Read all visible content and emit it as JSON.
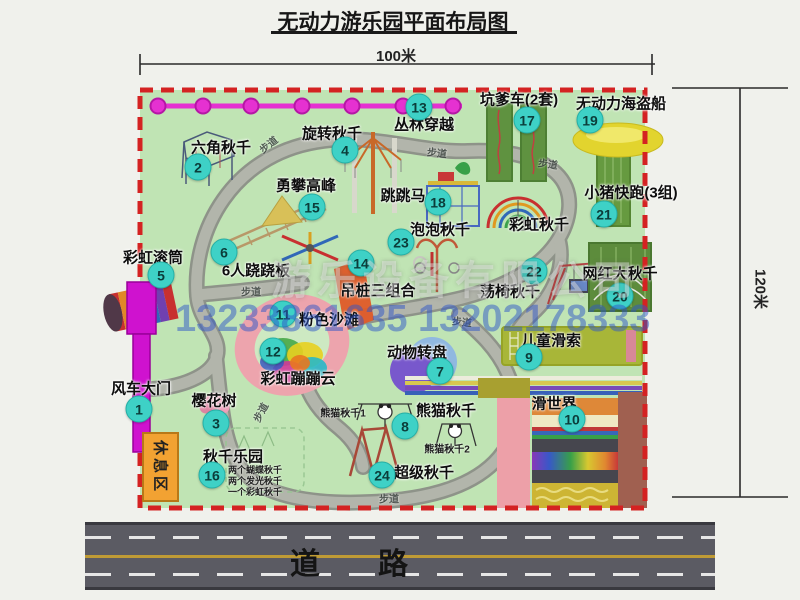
{
  "title": "无动力游乐园平面布局图",
  "dimensions": {
    "top": "100米",
    "right": "120米"
  },
  "road": {
    "label": "道路"
  },
  "watermark": {
    "company": "游乐设备有限公司",
    "phones": "13233861635 13202178333"
  },
  "rest_area": {
    "label": "休息区"
  },
  "walkway_label": "步道",
  "rainbow_swing_label": "彩虹秋千",
  "panda_notes": {
    "n1": "熊猫秋千1",
    "n2": "熊猫秋千2"
  },
  "swing_park_notes": [
    "两个蝴蝶秋千",
    "两个发光秋千",
    "一个彩虹秋千"
  ],
  "colors": {
    "park_green": "#c0e4b4",
    "border_red": "#d42222",
    "marker_teal": "#3ed1c6",
    "chain_magenta": "#e531d1",
    "gate_magenta": "#cf12cf",
    "rest_orange": "#f2a232",
    "road_gray": "#5b5b63"
  },
  "attractions": [
    {
      "num": "1",
      "name": "风车大门",
      "mx": 139,
      "my": 409,
      "lx": 141,
      "ly": 388
    },
    {
      "num": "2",
      "name": "六角秋千",
      "mx": 198,
      "my": 167,
      "lx": 221,
      "ly": 147
    },
    {
      "num": "3",
      "name": "樱花树",
      "mx": 216,
      "my": 423,
      "lx": 214,
      "ly": 400
    },
    {
      "num": "4",
      "name": "旋转秋千",
      "mx": 345,
      "my": 150,
      "lx": 332,
      "ly": 133
    },
    {
      "num": "5",
      "name": "彩虹滚筒",
      "mx": 161,
      "my": 275,
      "lx": 153,
      "ly": 257
    },
    {
      "num": "6",
      "name": "6人跷跷板",
      "mx": 224,
      "my": 252,
      "lx": 256,
      "ly": 270
    },
    {
      "num": "7",
      "name": "动物转盘",
      "mx": 440,
      "my": 371,
      "lx": 417,
      "ly": 352
    },
    {
      "num": "8",
      "name": "熊猫秋千",
      "mx": 405,
      "my": 426,
      "lx": 446,
      "ly": 410
    },
    {
      "num": "9",
      "name": "儿童滑索",
      "mx": 529,
      "my": 357,
      "lx": 551,
      "ly": 340
    },
    {
      "num": "10",
      "name": "滑世界",
      "mx": 572,
      "my": 419,
      "lx": 554,
      "ly": 403
    },
    {
      "num": "11",
      "name": "粉色沙滩",
      "mx": 283,
      "my": 314,
      "lx": 329,
      "ly": 319
    },
    {
      "num": "12",
      "name": "彩虹蹦蹦云",
      "mx": 273,
      "my": 351,
      "lx": 298,
      "ly": 378
    },
    {
      "num": "13",
      "name": "丛林穿越",
      "mx": 419,
      "my": 107,
      "lx": 424,
      "ly": 124
    },
    {
      "num": "14",
      "name": "吊桩三组合",
      "mx": 361,
      "my": 263,
      "lx": 378,
      "ly": 290
    },
    {
      "num": "15",
      "name": "勇攀高峰",
      "mx": 312,
      "my": 207,
      "lx": 306,
      "ly": 185
    },
    {
      "num": "16",
      "name": "秋千乐园",
      "mx": 212,
      "my": 475,
      "lx": 233,
      "ly": 456
    },
    {
      "num": "17",
      "name": "坑爹车(2套)",
      "mx": 527,
      "my": 120,
      "lx": 519,
      "ly": 99
    },
    {
      "num": "18",
      "name": "跳跳马",
      "mx": 438,
      "my": 202,
      "lx": 403,
      "ly": 195
    },
    {
      "num": "19",
      "name": "无动力海盗船",
      "mx": 590,
      "my": 120,
      "lx": 621,
      "ly": 103
    },
    {
      "num": "20",
      "name": "网红大秋千",
      "mx": 620,
      "my": 296,
      "lx": 620,
      "ly": 273
    },
    {
      "num": "21",
      "name": "小猪快跑(3组)",
      "mx": 604,
      "my": 214,
      "lx": 631,
      "ly": 192
    },
    {
      "num": "22",
      "name": "荡椅秋千",
      "mx": 534,
      "my": 271,
      "lx": 510,
      "ly": 291
    },
    {
      "num": "23",
      "name": "泡泡秋千",
      "mx": 401,
      "my": 242,
      "lx": 440,
      "ly": 229
    },
    {
      "num": "24",
      "name": "超级秋千",
      "mx": 382,
      "my": 475,
      "lx": 424,
      "ly": 472
    }
  ],
  "walk_label_positions": [
    {
      "x": 268,
      "y": 144,
      "r": -38
    },
    {
      "x": 437,
      "y": 152,
      "r": 6
    },
    {
      "x": 548,
      "y": 163,
      "r": 8
    },
    {
      "x": 251,
      "y": 291,
      "r": 0
    },
    {
      "x": 462,
      "y": 321,
      "r": 6
    },
    {
      "x": 260,
      "y": 412,
      "r": -62
    },
    {
      "x": 389,
      "y": 498,
      "r": 0
    }
  ],
  "chain": {
    "dots_x": [
      158,
      203,
      251,
      302,
      352,
      403,
      453
    ],
    "y": 106
  }
}
